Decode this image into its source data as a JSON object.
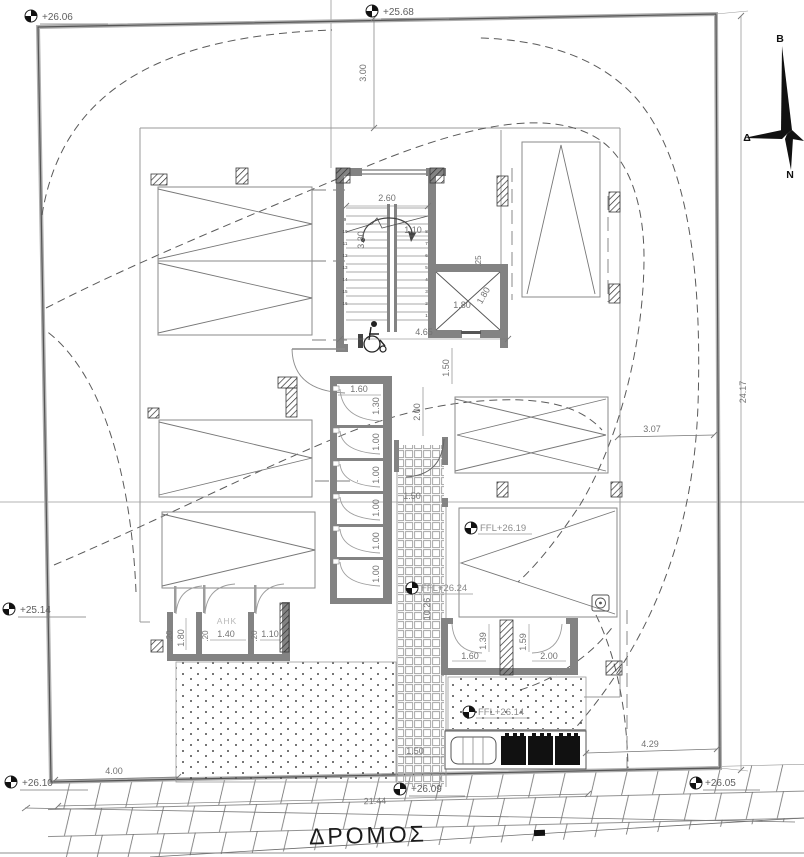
{
  "drawing": {
    "road_label": "ΔΡΟΜΟΣ",
    "room_label_ahk": "AHK",
    "compass": {
      "north": "B",
      "west": "Δ",
      "south": "N"
    },
    "spot_elevations": {
      "top_left": "+26.06",
      "top_center": "+25.68",
      "left": "+25.14",
      "bottom_left": "+26.10",
      "bottom_center": "+26.09",
      "bottom_right": "+26.05"
    },
    "floor_levels": {
      "parking": "FFL+26.19",
      "path": "FFL+26.24",
      "plaza": "FFL+26.14"
    },
    "site_dimensions": {
      "top_setback": "3.00",
      "right_setback": "3.07",
      "right_boundary": "24.17",
      "bottom_left": "4.00",
      "road_frontage": "21.44",
      "bottom_right": "4.29"
    },
    "stair": {
      "width": "2.60",
      "flight": "1.10",
      "length": "3.30",
      "lobby": "4.65",
      "lobby_depth": "1.50",
      "steps_left_display": [
        "9",
        "10",
        "11",
        "12",
        "13",
        "14",
        "15",
        "16"
      ],
      "steps_right_display": [
        "8",
        "7",
        "6",
        "5",
        "4",
        "3",
        "2",
        "1"
      ]
    },
    "elevator": {
      "width": "1.80",
      "depth": "1.80",
      "wall": ".25"
    },
    "path": {
      "top_width": "2.00",
      "width": "1.50",
      "length": "10.26",
      "bottom_width": "1.50"
    },
    "stores": {
      "width": "1.60",
      "first_depth": "1.30",
      "depth": "1.00"
    },
    "meter_rooms": {
      "wall": ".20",
      "d1": "1.80",
      "d2": "1.40",
      "d3": "1.10"
    },
    "south_rooms": {
      "w1": "1.60",
      "d1": "1.39",
      "w2": "2.00",
      "d2": "1.59"
    }
  }
}
